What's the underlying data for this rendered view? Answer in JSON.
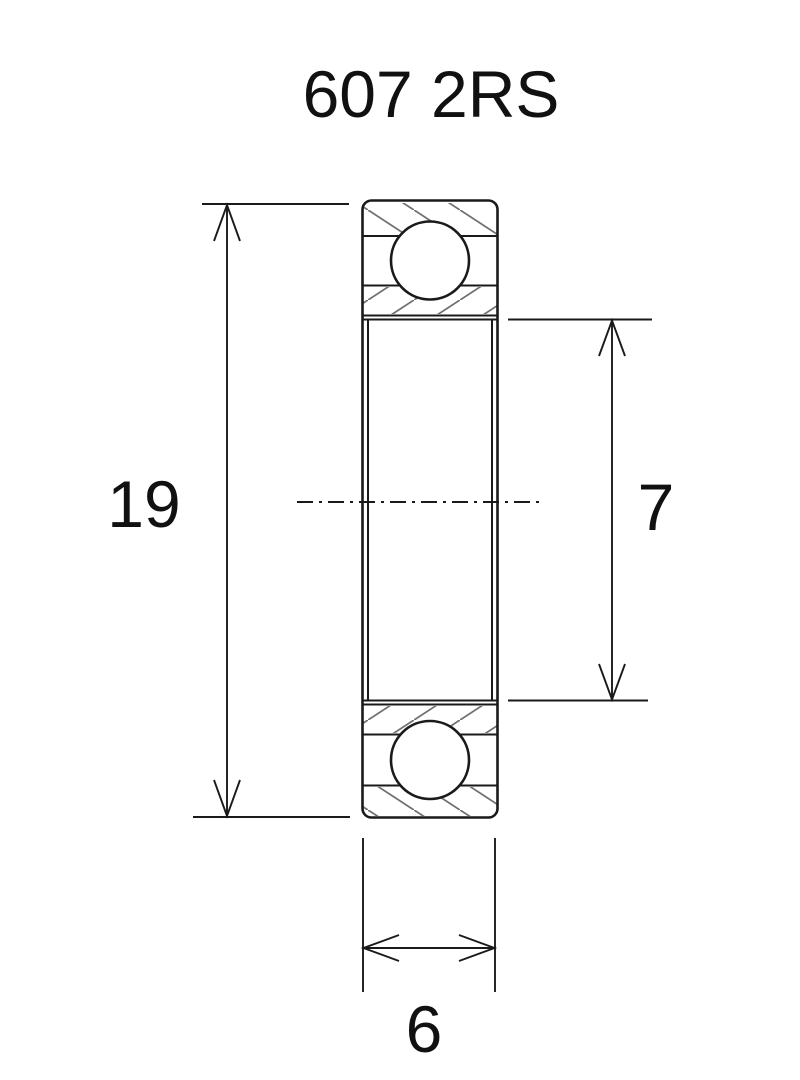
{
  "title": "607 2RS",
  "dimensions": {
    "outer_diameter": "19",
    "bore_diameter": "7",
    "width": "6"
  },
  "colors": {
    "background": "#ffffff",
    "line": "#1a1a1a",
    "hatch": "#707070"
  }
}
